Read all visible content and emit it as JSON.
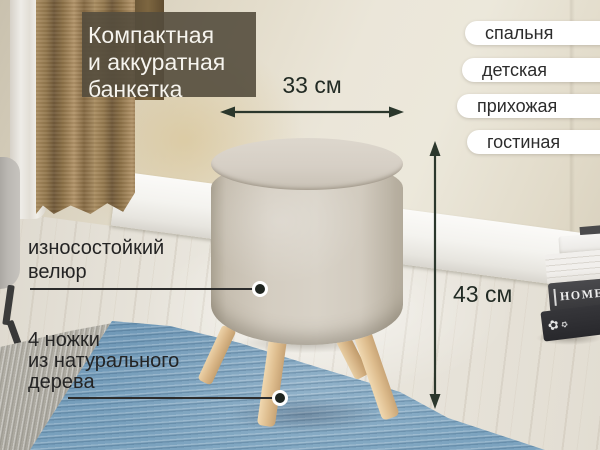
{
  "badge": {
    "lines": [
      "Компактная",
      "и аккуратная",
      "банкетка"
    ]
  },
  "room_tags": [
    {
      "label": "спальня"
    },
    {
      "label": "детская"
    },
    {
      "label": "прихожая"
    },
    {
      "label": "гостиная"
    }
  ],
  "dimensions": {
    "width": "33 см",
    "height": "43 см"
  },
  "callouts": {
    "material": {
      "lines": [
        "износостойкий",
        "велюр"
      ]
    },
    "legs": {
      "lines": [
        "4 ножки",
        "из натурального",
        "дерева"
      ]
    }
  },
  "props": {
    "book_spine": "HOME",
    "ornament_glyph": "✿"
  },
  "colors": {
    "arrow_accent": "#2b372c",
    "badge_bg": "rgba(84,76,61,0.9)",
    "pill_bg": "#ffffff",
    "text_dark": "#242424",
    "stool_fabric": "#d5cfc4",
    "leg_wood": "#ddbc8d",
    "rug_blue": "#7aa2c0"
  }
}
